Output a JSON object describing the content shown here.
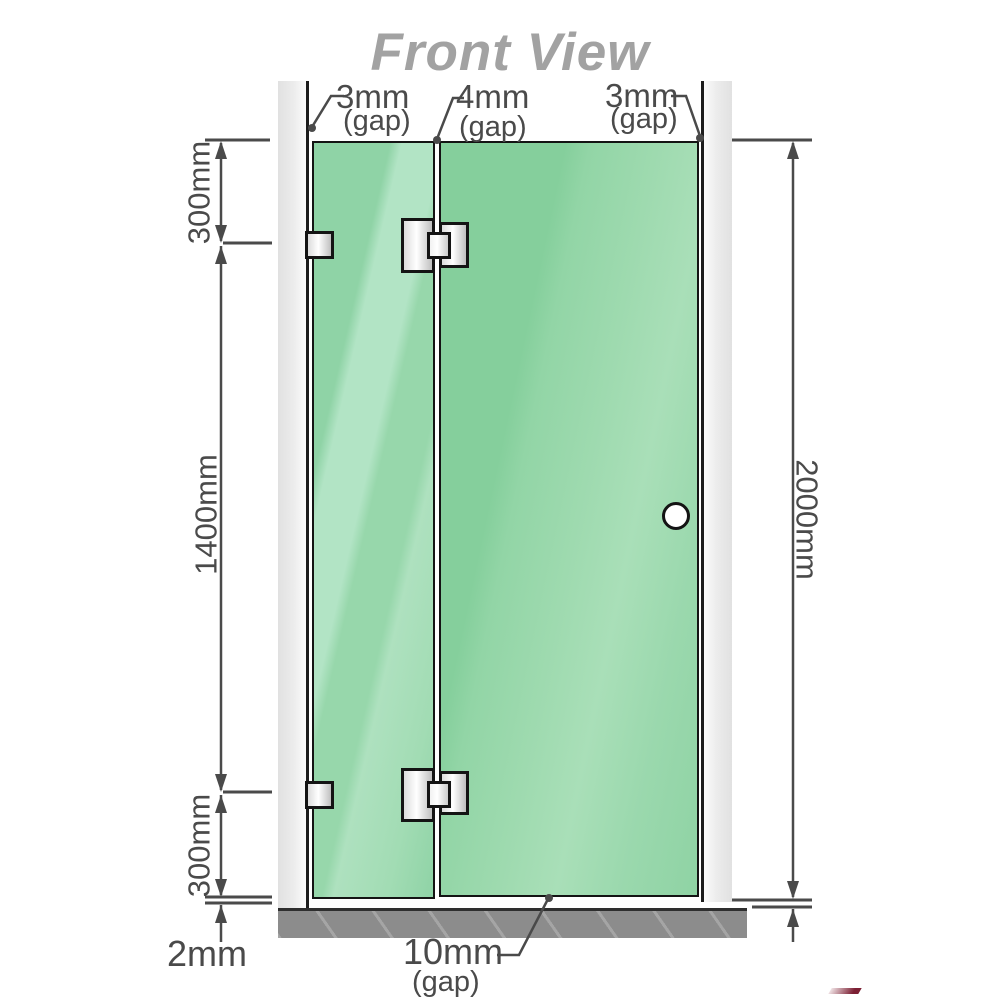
{
  "title": "Front View",
  "dimensions": {
    "top_left_gap": {
      "value": "3mm",
      "label": "(gap)"
    },
    "top_mid_gap": {
      "value": "4mm",
      "label": "(gap)"
    },
    "top_right_gap": {
      "value": "3mm",
      "label": "(gap)"
    },
    "left_top": "300mm",
    "left_middle": "1400mm",
    "left_bottom": "300mm",
    "right_total": "2000mm",
    "floor_gap": "2mm",
    "bottom_door_gap": {
      "value": "10mm",
      "label": "(gap)"
    }
  },
  "colors": {
    "glass_green": "#8fd3a6",
    "glass_highlight": "#b2e4c5",
    "floor_gray": "#8c8c8c",
    "wall_gray": "#e6e6e6",
    "line_dark": "#4a4a4a",
    "title_gray": "#a2a2a2",
    "metal_light": "#ffffff",
    "metal_dark": "#bfbfbf"
  }
}
